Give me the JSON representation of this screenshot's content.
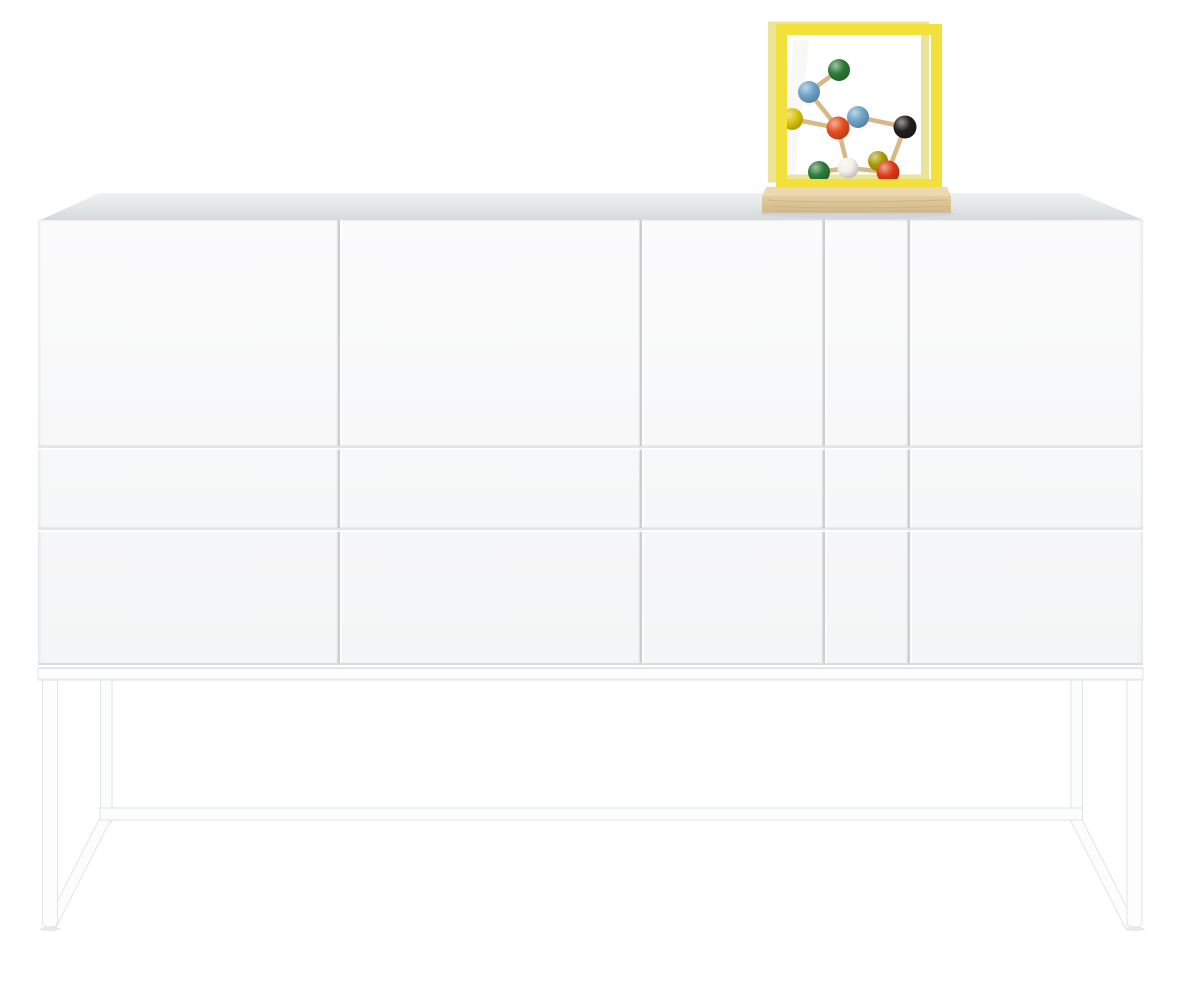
{
  "scene": {
    "background_color": "#ffffff",
    "description": "White sideboard on slim white metal sled base; on top sits a yellow-framed glass display cube on a wooden plinth containing a colorful wooden molecule model"
  },
  "sideboard": {
    "description": "white lacquered sideboard, four door fronts over two drawer rows, seamless push-open fronts",
    "body": {
      "face_top_color": "#fbfbfc",
      "face_bottom_color": "#f4f5f6",
      "top_surface_back_color": "#eff1f2",
      "top_surface_front_color": "#d6d9db",
      "bottom_edge_color": "#d9dcdd",
      "vertical_seam_color": "#cbcdcf",
      "horizontal_seam_color": "#e3e5e6"
    },
    "base_frame": {
      "description": "thin white steel sled base: front legs, rear legs, rear floor stretcher, sloped side runners",
      "fill": "#fdfdfe",
      "back_fill": "#fbfcfc",
      "stroke": "#e2e4e6",
      "rail_shade": "#eef0f1",
      "under_cabinet_shadow": "#dcdedf",
      "floor_shadow": "#e8eaea"
    }
  },
  "display_cube": {
    "description": "yellow metal-framed glass cube on wooden plinth",
    "frame_front_color": "#f2e13b",
    "frame_back_color": "#ebe398",
    "glass_streak_color": "#f3f3ee",
    "wood_plinth": {
      "top_color": "#ecd9b1",
      "front_light_color": "#e4cda1",
      "front_dark_color": "#d3b788",
      "grain_color": "#c3a87a",
      "cast_shadow_color": "#c9ccce"
    }
  },
  "molecule": {
    "description": "vintage wooden molecule model with colored balls and tan sticks",
    "stick_color": "#d8b887",
    "stick_width": 4.5,
    "balls": [
      {
        "name": "green-top",
        "color": "#2d7a38",
        "x": 839,
        "y": 70,
        "r": 11
      },
      {
        "name": "blue-upper-left",
        "color": "#6fa3c8",
        "x": 809,
        "y": 92,
        "r": 11
      },
      {
        "name": "blue-center",
        "color": "#6fa3c8",
        "x": 858,
        "y": 117,
        "r": 11
      },
      {
        "name": "yellow-left",
        "color": "#d9c40e",
        "x": 792,
        "y": 119,
        "r": 11
      },
      {
        "name": "orange-center",
        "color": "#e64e1e",
        "x": 838,
        "y": 128,
        "r": 11.5
      },
      {
        "name": "black-right",
        "color": "#211e1c",
        "x": 905,
        "y": 127,
        "r": 11.5
      },
      {
        "name": "olive-lower",
        "color": "#ab9c04",
        "x": 878,
        "y": 161,
        "r": 10
      },
      {
        "name": "green-lower-left",
        "color": "#2d7a38",
        "x": 819,
        "y": 172,
        "r": 11
      },
      {
        "name": "white-lower",
        "color": "#f3f0e8",
        "x": 848,
        "y": 168,
        "r": 10.5
      },
      {
        "name": "red-lower-right",
        "color": "#de3a18",
        "x": 888,
        "y": 172,
        "r": 11.5
      }
    ],
    "sticks": [
      [
        "green-top",
        "blue-upper-left"
      ],
      [
        "blue-upper-left",
        "orange-center"
      ],
      [
        "yellow-left",
        "orange-center"
      ],
      [
        "blue-center",
        "orange-center"
      ],
      [
        "blue-center",
        "black-right"
      ],
      [
        "orange-center",
        "white-lower"
      ],
      [
        "black-right",
        "red-lower-right"
      ],
      [
        "white-lower",
        "green-lower-left"
      ],
      [
        "white-lower",
        "red-lower-right"
      ]
    ]
  }
}
